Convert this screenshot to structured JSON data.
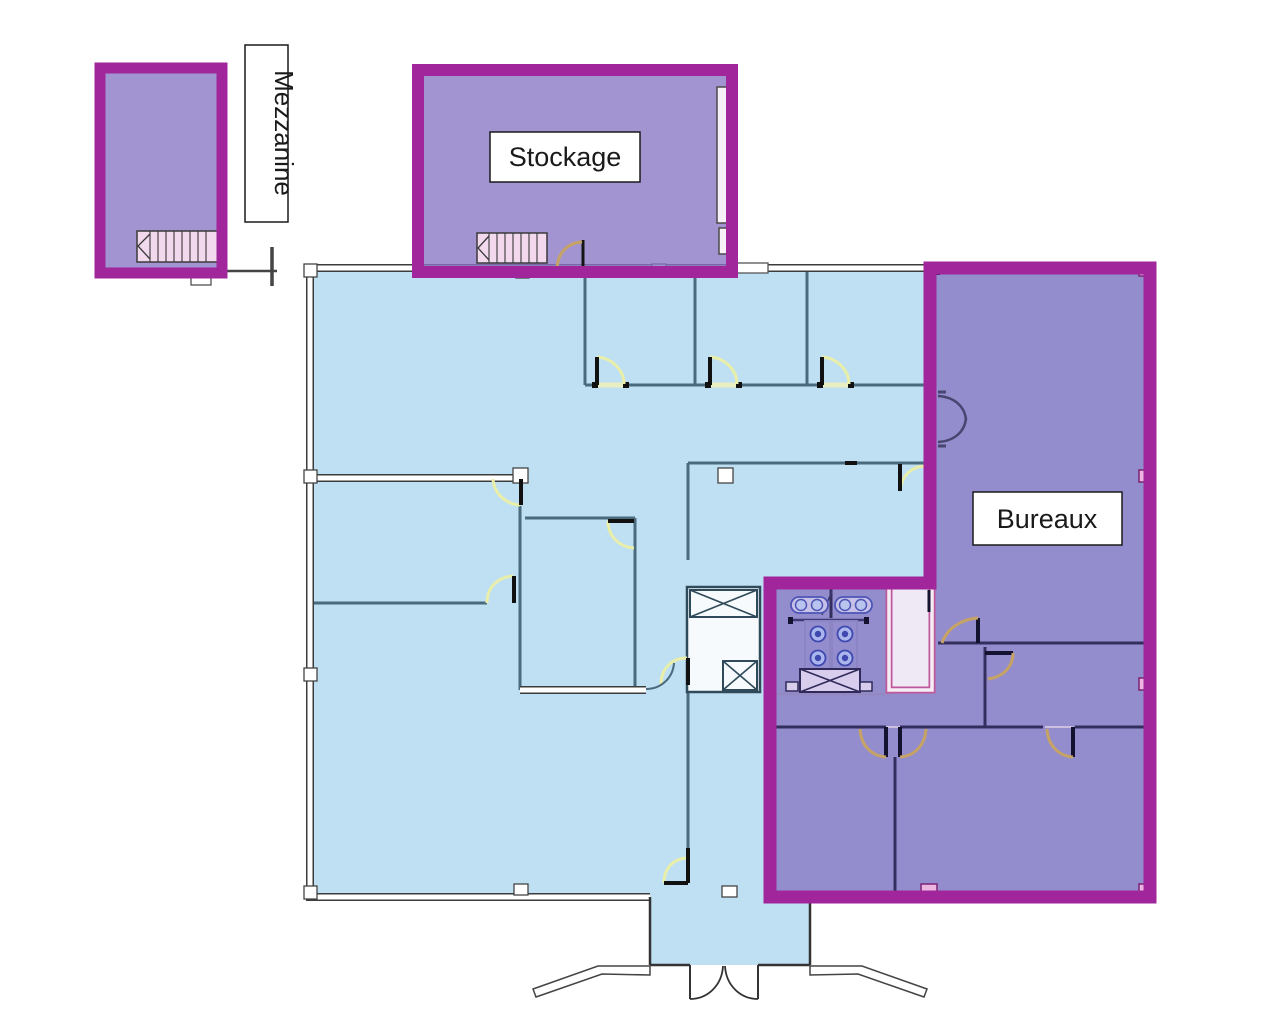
{
  "diagram": {
    "type": "floor-plan",
    "labels": {
      "mezzanine": "Mezzanine",
      "stockage": "Stockage",
      "bureaux": "Bureaux"
    },
    "zones": [
      {
        "id": "mezzanine",
        "label": "Mezzanine"
      },
      {
        "id": "stockage",
        "label": "Stockage"
      },
      {
        "id": "bureaux",
        "label": "Bureaux"
      },
      {
        "id": "main-floor",
        "label": ""
      }
    ],
    "colors": {
      "floor_fill": "#bfe0f2",
      "zone_fill": "rgba(134,118,196,0.78)",
      "zone_border": "#a1269b",
      "wall_grey": "#4a6a7d",
      "outer_wall_edge": "#3c3c3c",
      "door_arc_yellow": "#e9efa8",
      "door_arc_tan": "#c6a365",
      "navy_wall": "#332e5e",
      "fixture_blue": "#3f49b0",
      "stair_pink": "#f2d9ee",
      "notch_pink": "#edb6e0",
      "label_box_fill": "#ffffff",
      "label_box_border": "#1a1a1a"
    }
  }
}
